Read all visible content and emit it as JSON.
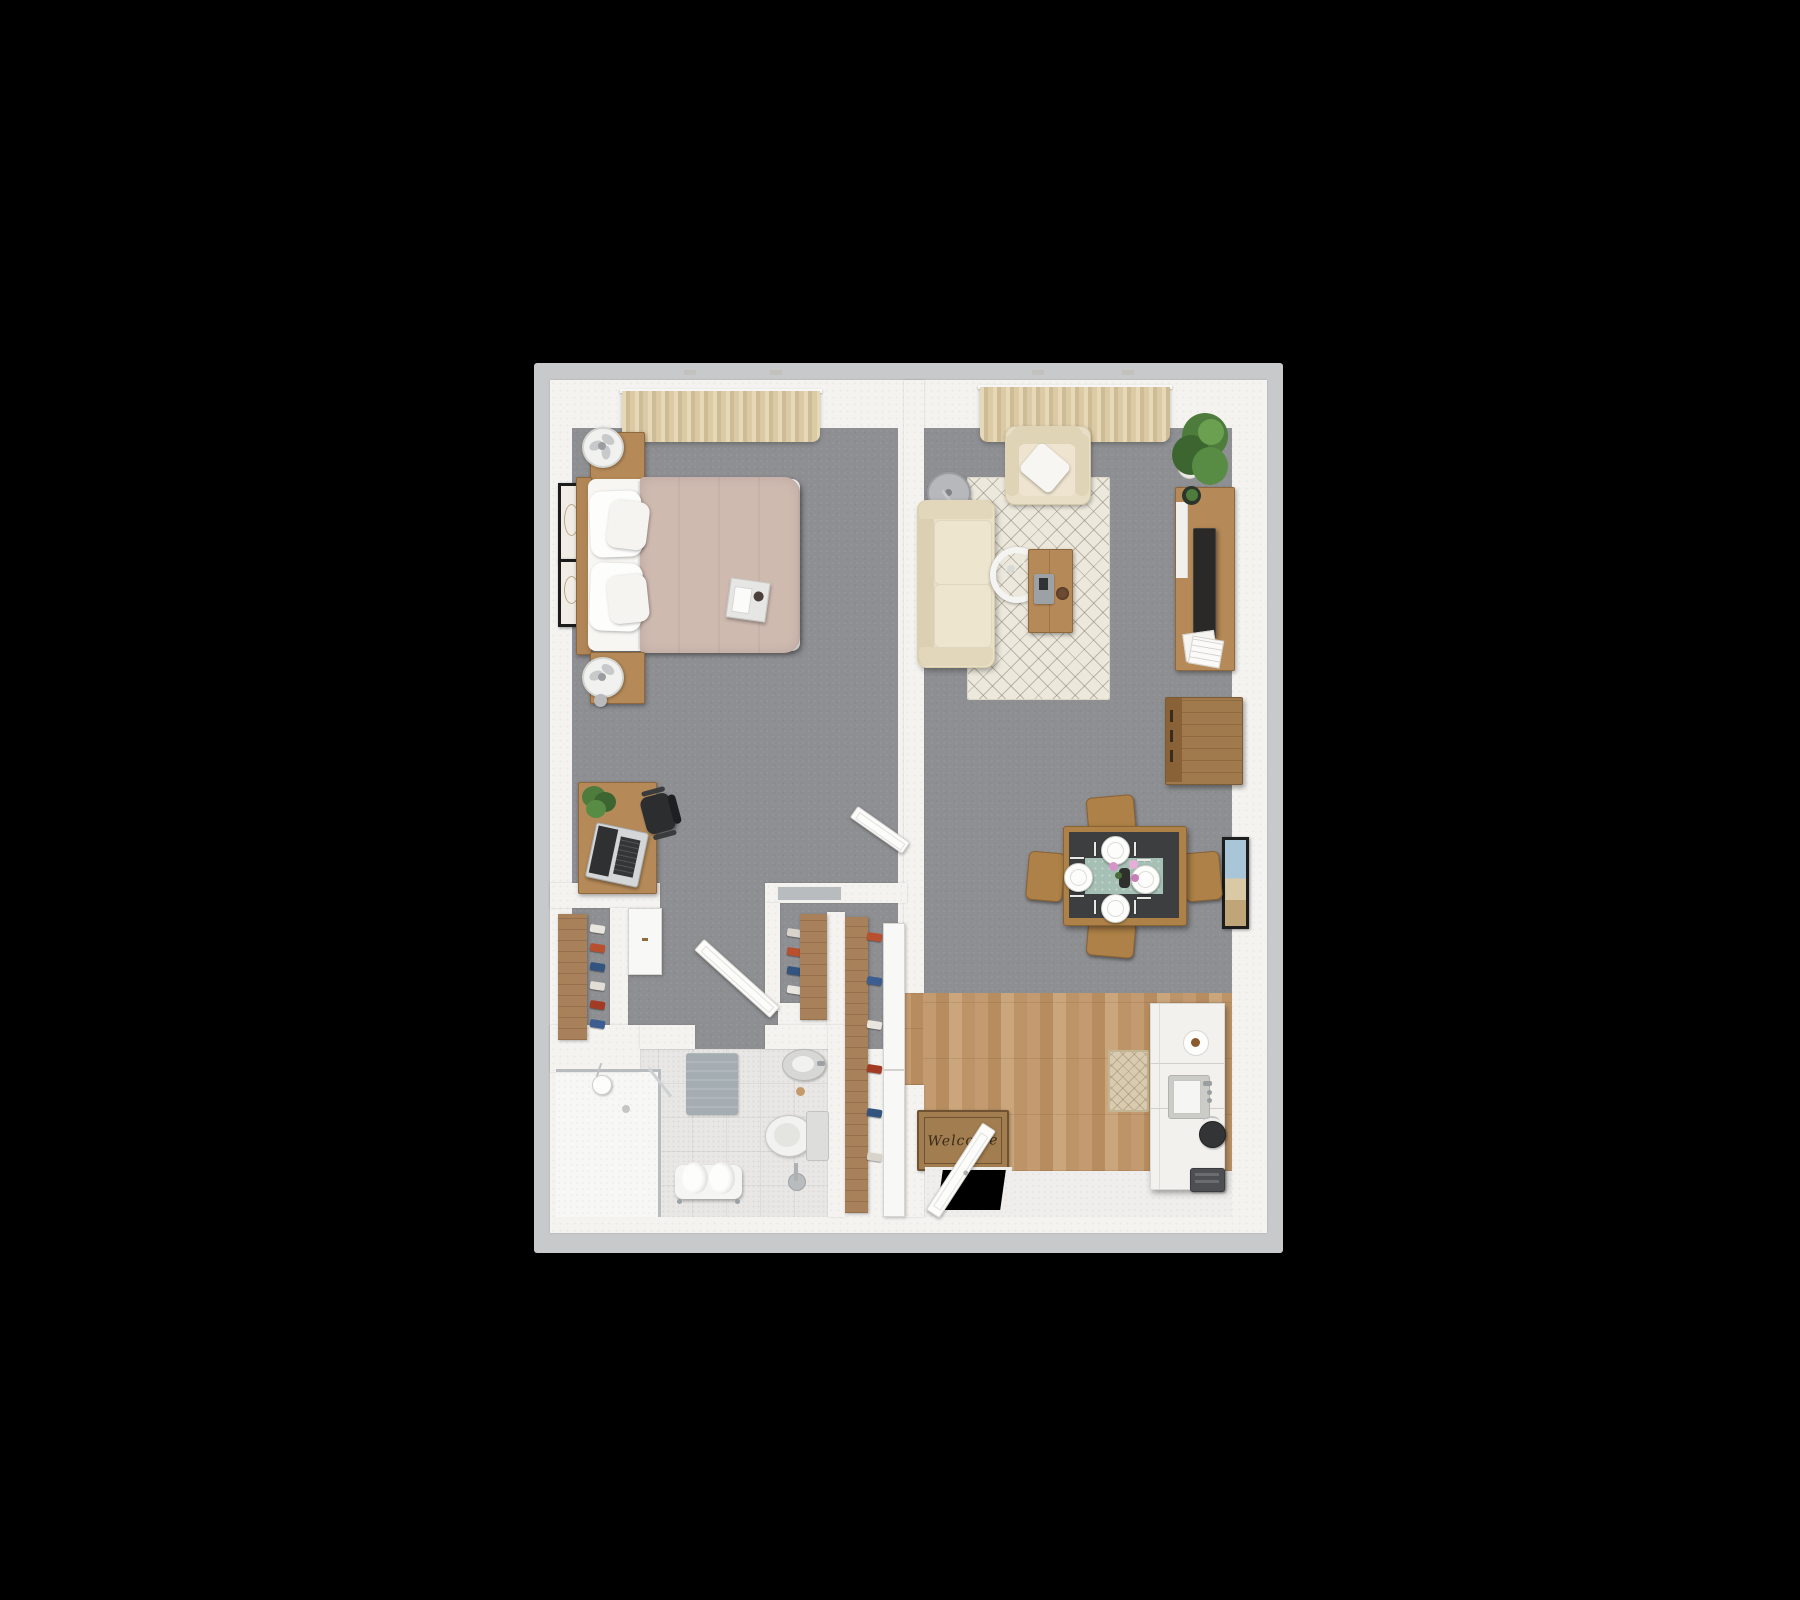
{
  "scene": {
    "type": "3d-rendered top-down floor plan",
    "subject": "one-bedroom apartment",
    "background_color": "#000000"
  },
  "entry": {
    "welcome_mat_text": "Welcome"
  },
  "rooms": {
    "bedroom": {
      "floor": "gray carpet",
      "items": [
        "bed with blush duvet",
        "breakfast tray",
        "nightstand x2",
        "table fan x2",
        "framed art x2",
        "window curtains",
        "desk",
        "laptop",
        "desk plant",
        "office chair"
      ]
    },
    "living_room": {
      "floor": "gray carpet",
      "items": [
        "cream sofa",
        "armchair",
        "throw pillow",
        "arc floor lamp",
        "drum pendant",
        "area rug",
        "coffee table",
        "remote tray",
        "decor bowl",
        "tv console",
        "tv",
        "magazines",
        "corner plant",
        "storage crate",
        "framed art",
        "window curtains"
      ]
    },
    "dining_area": {
      "items": [
        "dining table",
        "dining chair x4",
        "place setting x4",
        "table runner",
        "flower vase"
      ]
    },
    "kitchen_entry": {
      "floor": "wood planks",
      "items": [
        "counter with fridge",
        "sink",
        "kettle",
        "toaster",
        "plate of pastry",
        "runner rug",
        "welcome mat",
        "front door"
      ]
    },
    "bathroom": {
      "floor": "speckled tile",
      "items": [
        "walk-in shower",
        "glass panel",
        "pendant light",
        "bath mat",
        "towel bench",
        "toilet",
        "toilet paper stand",
        "round sink"
      ]
    },
    "hallway_closets": {
      "items": [
        "shoe rack west",
        "shoe rack middle",
        "entry wardrobe",
        "sliding doors",
        "interior door x2"
      ]
    }
  },
  "closet_item_colors": {
    "west_rack": [
      "#e9e5df",
      "#b8502f",
      "#32547f",
      "#e2ded6",
      "#a33b24",
      "#3b5d8f"
    ],
    "middle_rack": [
      "#d8d4cc",
      "#b8502f",
      "#32547f",
      "#e9e5df"
    ],
    "entry_rack": [
      "#b8502f",
      "#3b5d8f",
      "#e9e5df",
      "#a33b24",
      "#32547f",
      "#d8d4cc"
    ]
  },
  "palette": {
    "outer_wall": "#c8c9cb",
    "inner_wall": "#f4f3f0",
    "carpet": "#8e8f92",
    "wood_floor": "#c49b70",
    "bathroom_tile": "#e8e7e5",
    "wood_furniture": "#b68a58",
    "closet_wood": "#a8815a",
    "sofa_cream": "#e9e0c8",
    "duvet_blush": "#cfbab0",
    "rug_ivory": "#ece8dc",
    "runner_teal": "#a6c0b6",
    "tv_black": "#2b2927",
    "mat_brown": "#a27d50",
    "plant_green": "#4d7c3c",
    "glass_gray": "#b8bcbe"
  }
}
